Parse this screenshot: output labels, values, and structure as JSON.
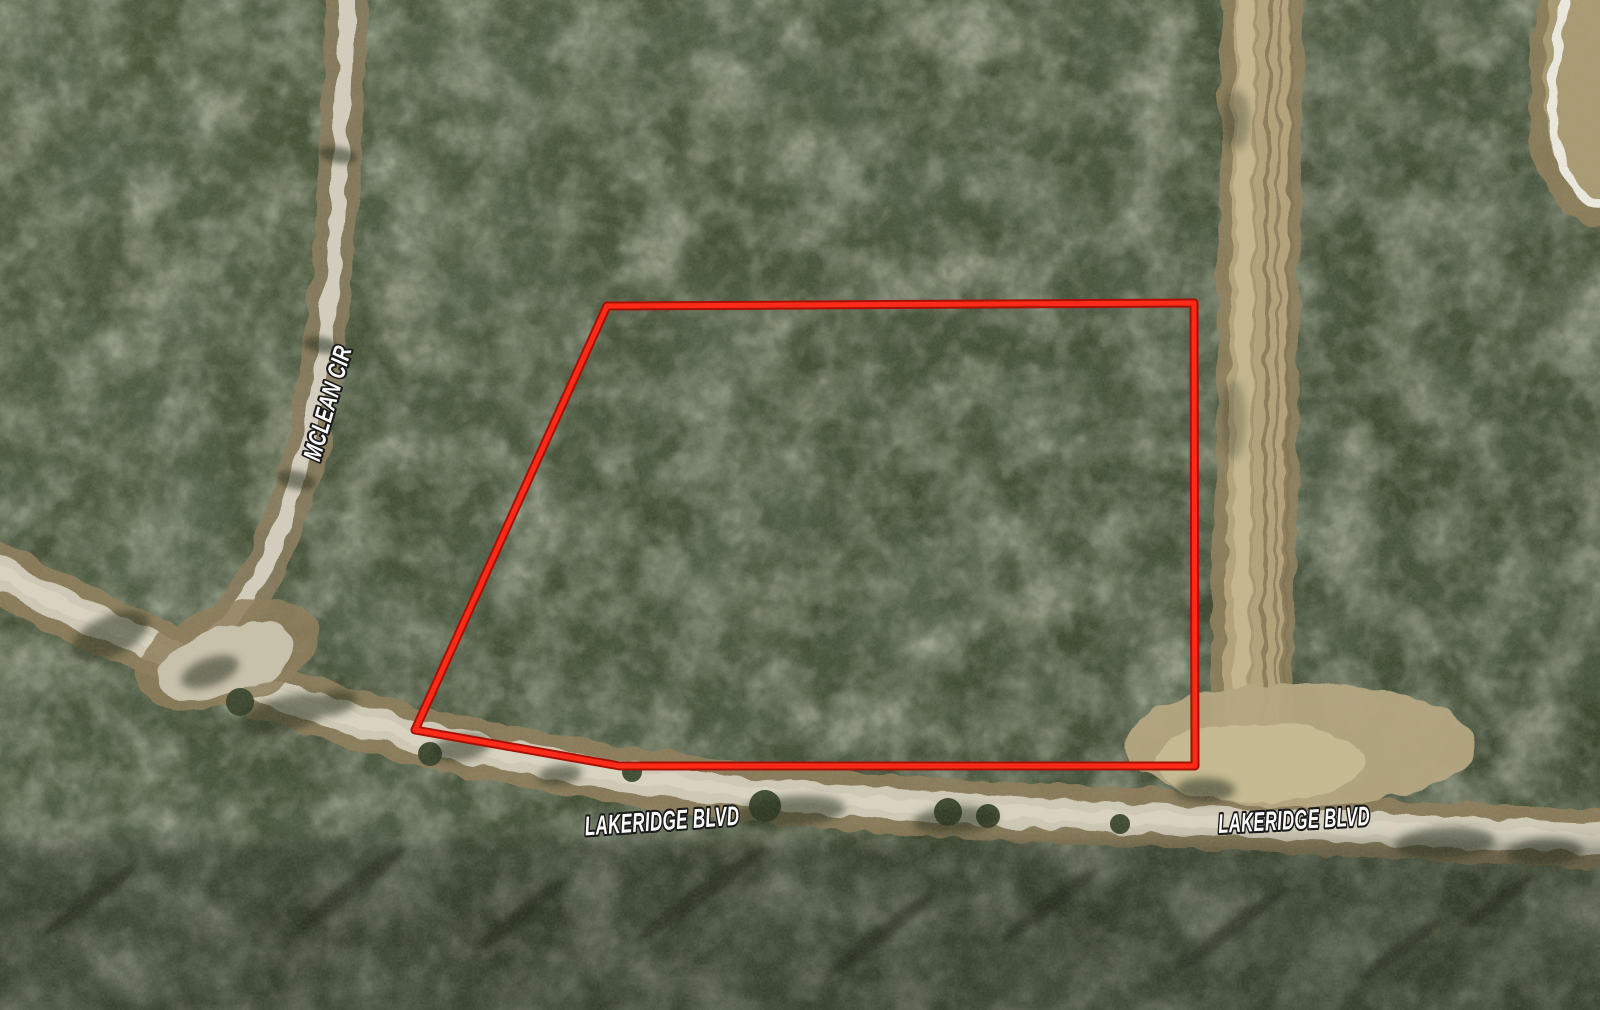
{
  "map": {
    "view": "aerial-satellite",
    "labels": {
      "mclean_cir": "MCLEAN CIR",
      "lakeridge_blvd_west": "LAKERIDGE BLVD",
      "lakeridge_blvd_east": "LAKERIDGE BLVD"
    },
    "label_style": {
      "fill": "#ffffff",
      "outline": "#1b1b1b"
    },
    "parcel": {
      "points": "607,306 1194,303 1195,766 620,766 415,730",
      "outline_color": "#ff2b18",
      "outline_edge_color": "#a81004"
    },
    "terrain_colors": {
      "forest_base": "#42502f",
      "road_paved": "#cfc9b6",
      "road_dirt": "#b2a27a",
      "road_shoulder": "#8d7d5a"
    }
  }
}
